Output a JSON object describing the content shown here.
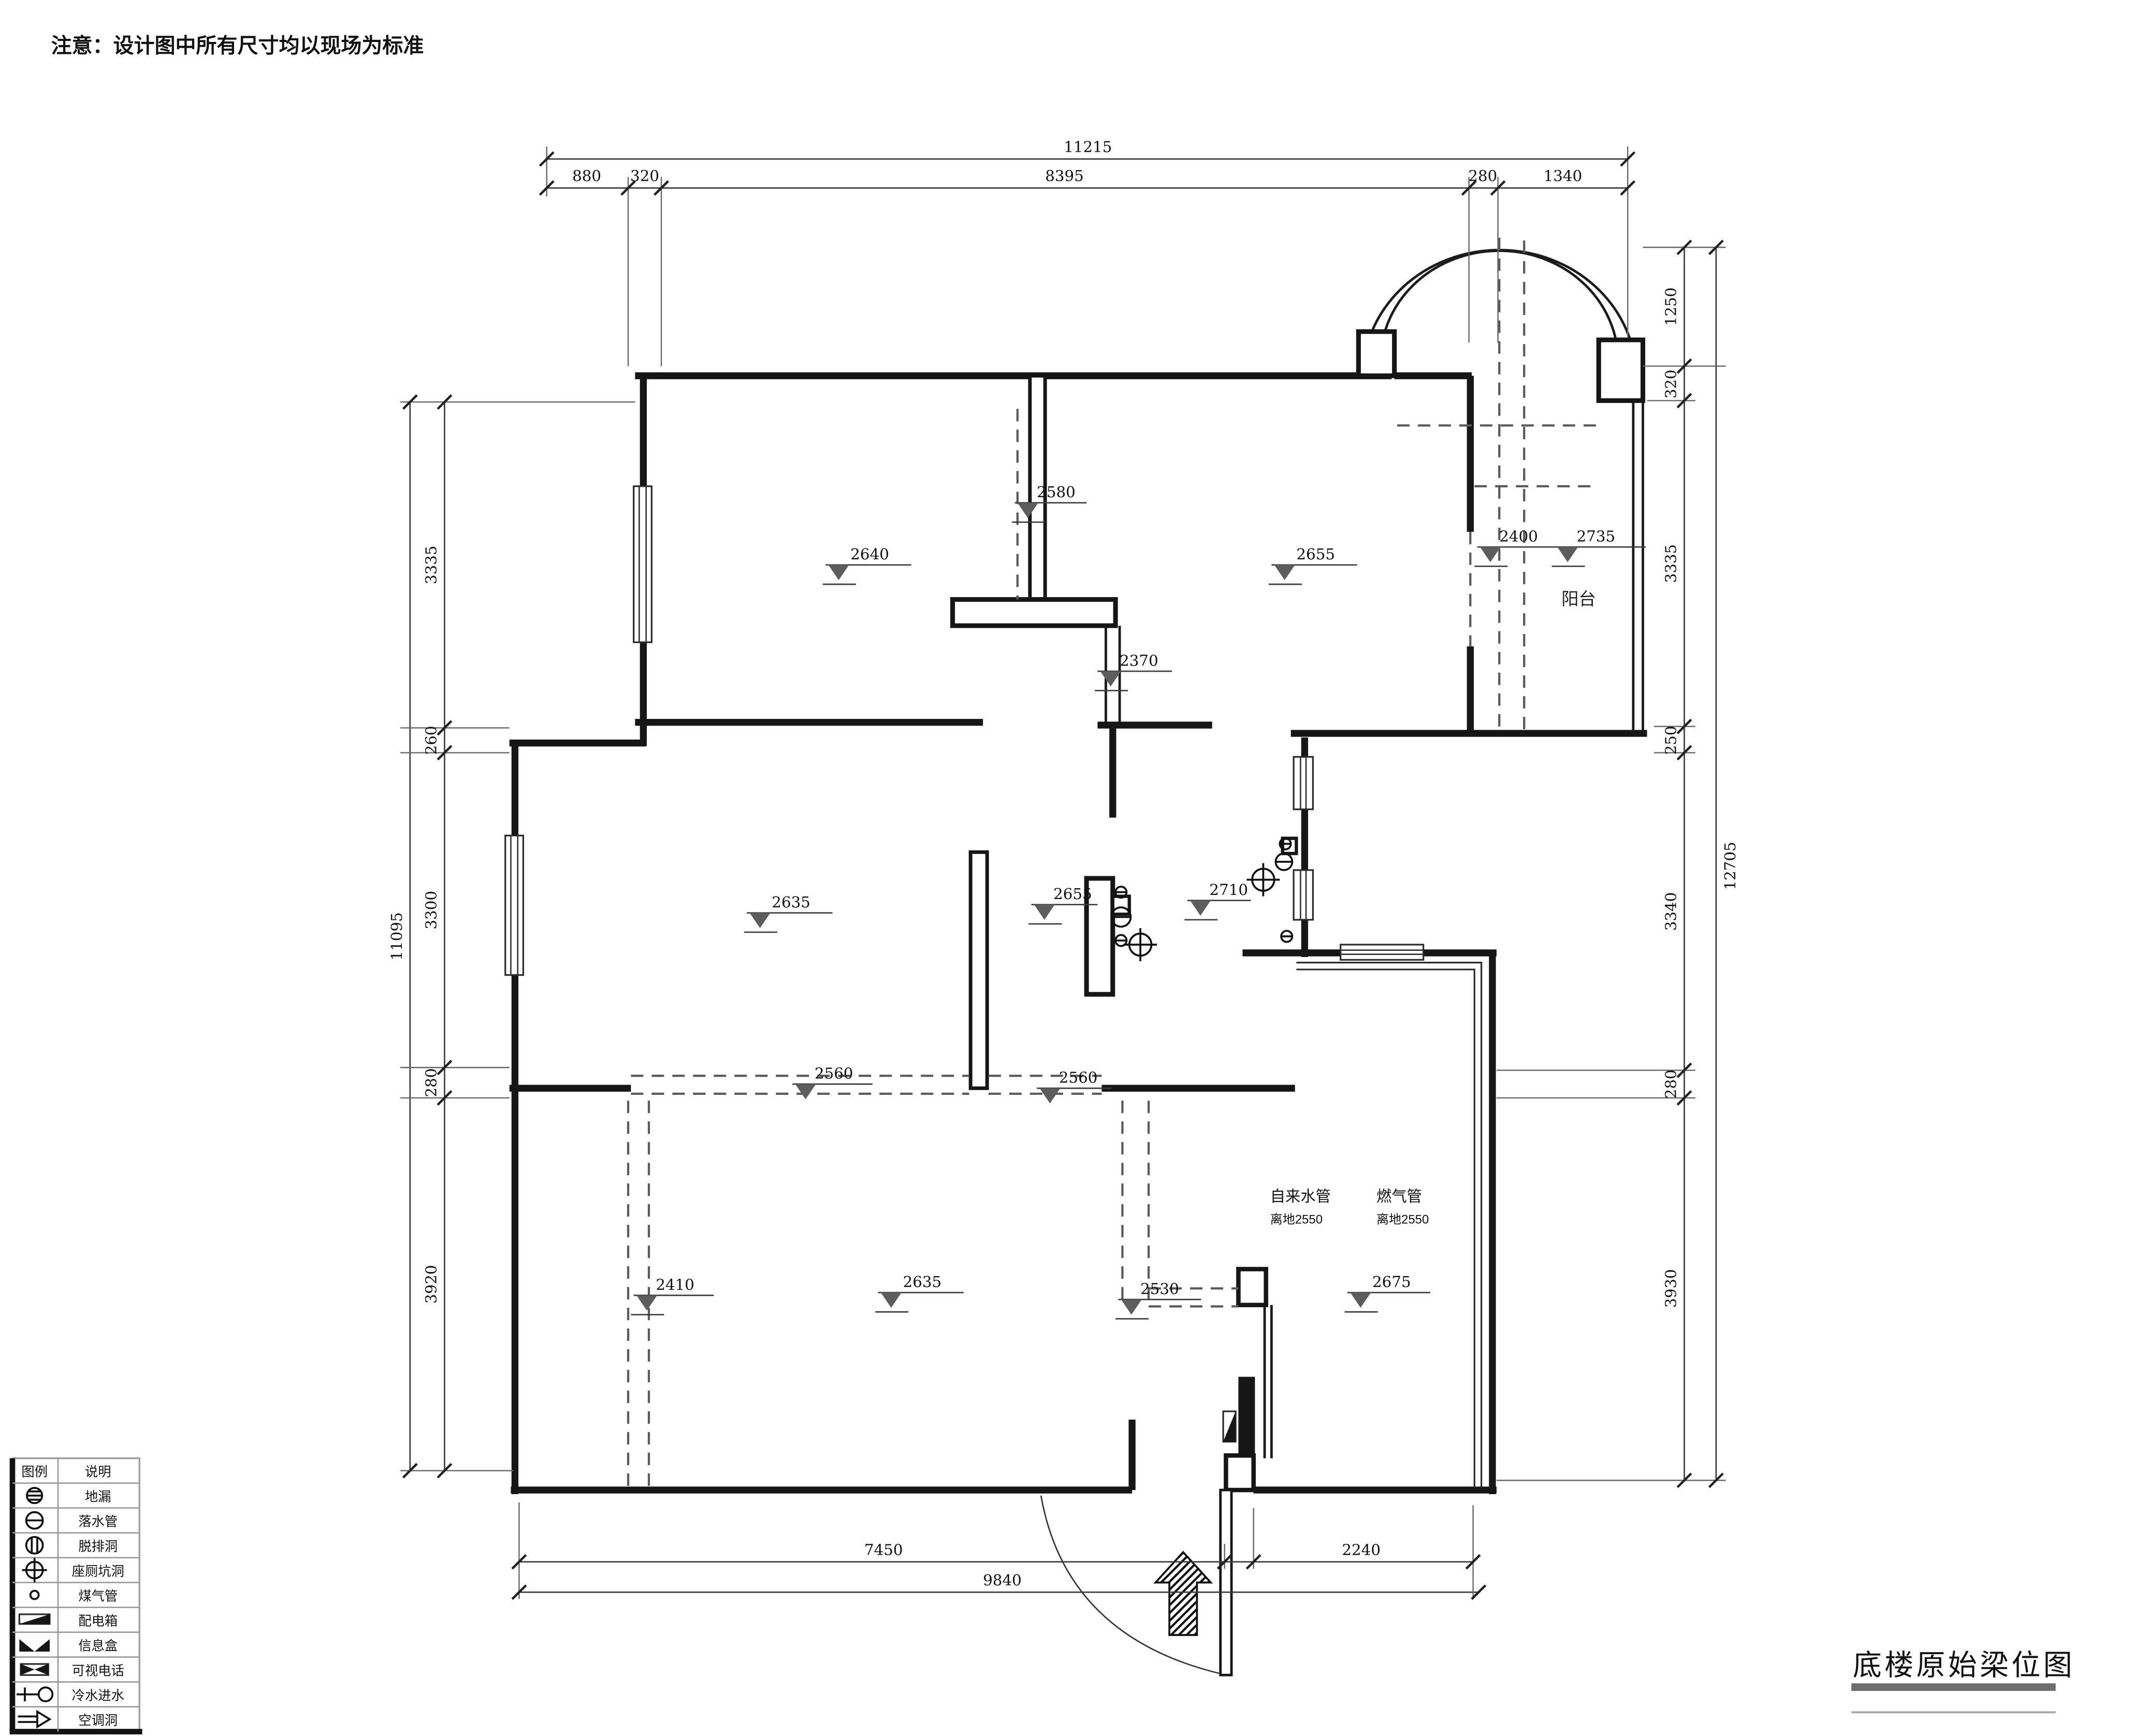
{
  "note": "注意：设计图中所有尺寸均以现场为标准",
  "title": "底楼原始梁位图",
  "plan_labels": {
    "balcony": "阳台"
  },
  "pipes": {
    "water": {
      "name": "自来水管",
      "height": "离地2550"
    },
    "gas": {
      "name": "燃气管",
      "height": "离地2550"
    }
  },
  "markers": [
    "2640",
    "2580",
    "2655",
    "2400",
    "2735",
    "2370",
    "2635",
    "2655",
    "2710",
    "2560",
    "2560",
    "2410",
    "2635",
    "2530",
    "2675"
  ],
  "dims": {
    "top": {
      "overall": "11215",
      "segments": [
        "880",
        "320",
        "8395",
        "280",
        "1340"
      ]
    },
    "left": {
      "overall": "11095",
      "segments": [
        "3335",
        "260",
        "3300",
        "280",
        "3920"
      ]
    },
    "right": {
      "overall": "12705",
      "segments": [
        "1250",
        "320",
        "3335",
        "250",
        "3340",
        "280",
        "3930"
      ]
    },
    "bottom": {
      "overall": "9840",
      "segments": [
        "7450",
        "2240"
      ]
    }
  },
  "legend": {
    "col_symbol": "图例",
    "col_desc": "说明",
    "rows": [
      {
        "icon": "floor-drain",
        "label": "地漏"
      },
      {
        "icon": "downpipe",
        "label": "落水管"
      },
      {
        "icon": "exhaust-hole",
        "label": "脱排洞"
      },
      {
        "icon": "toilet-pit",
        "label": "座厕坑洞"
      },
      {
        "icon": "gas-pipe",
        "label": "煤气管"
      },
      {
        "icon": "distribution-box",
        "label": "配电箱"
      },
      {
        "icon": "info-box",
        "label": "信息盒"
      },
      {
        "icon": "video-phone",
        "label": "可视电话"
      },
      {
        "icon": "cold-water-inlet",
        "label": "冷水进水"
      },
      {
        "icon": "ac-hole",
        "label": "空调洞"
      }
    ]
  }
}
